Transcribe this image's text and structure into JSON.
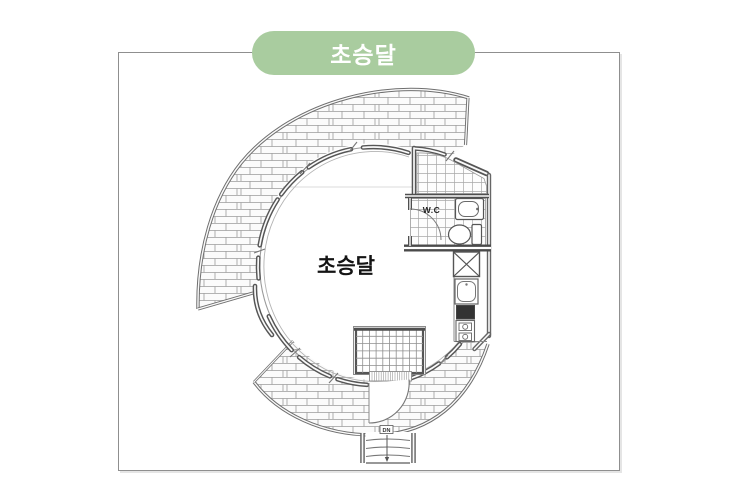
{
  "badge": {
    "label": "초승달",
    "background": "#a9cc9f",
    "text_color": "#ffffff"
  },
  "card": {
    "background": "#ffffff",
    "border_color": "#8f8f8f"
  },
  "floor_plan": {
    "room_label": "초승달",
    "wc_label": "W.C",
    "stair_direction_label": "DN",
    "line_color": "#6f6f6f",
    "wall_color": "#565656",
    "hatch_line_color": "#9c9c9c",
    "stove_fill": "#333333"
  }
}
